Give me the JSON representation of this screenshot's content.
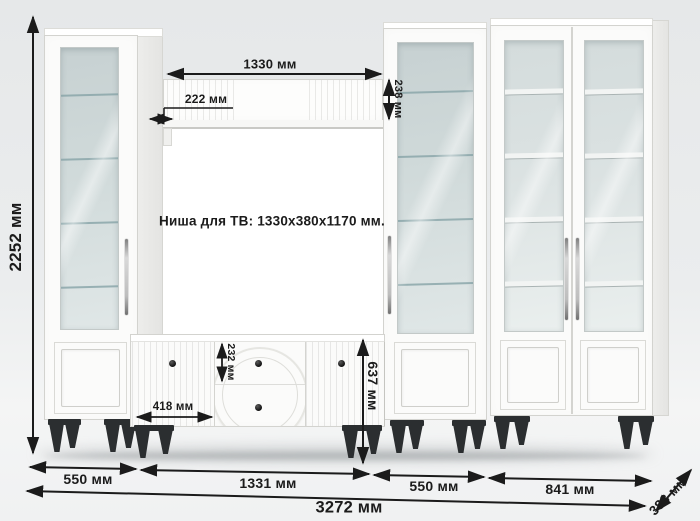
{
  "labels": {
    "tv_niche_note": "Ниша для ТВ: 1330x380x1170 мм."
  },
  "dims": {
    "total_height": "2252 мм",
    "niche_width_top": "1330 мм",
    "shelf_overhang": "222 мм",
    "top_shelf_height": "238 мм",
    "drawer_height": "232 мм",
    "stand_door_width": "418 мм",
    "stand_height": "637 мм",
    "left_cabinet_width": "550 мм",
    "niche_width_floor": "1331 мм",
    "right_cabinet_width": "550 мм",
    "wide_cabinet_width": "841 мм",
    "total_width": "3272 мм",
    "depth": "383 мм"
  },
  "colors": {
    "background": "#ebedee",
    "furniture_white": "#fbfbfa",
    "glass": "#cfd9d9",
    "legs_black": "#2b2e30",
    "dimension_ink": "#1b1b1b"
  }
}
